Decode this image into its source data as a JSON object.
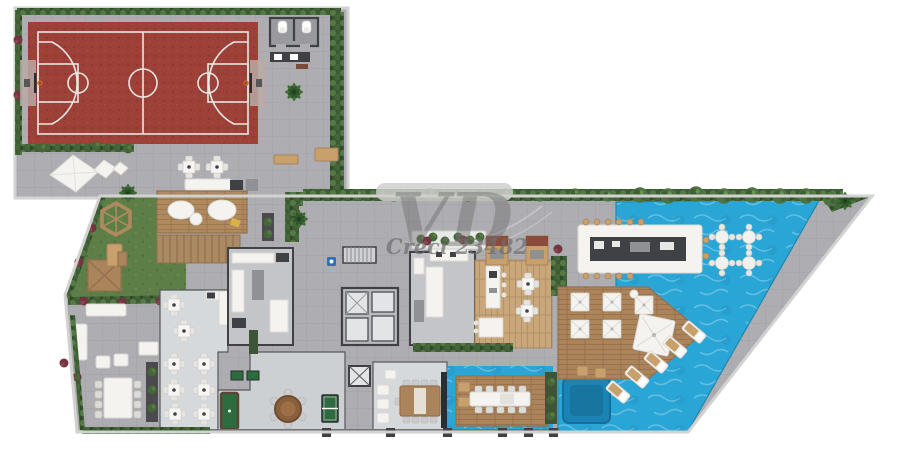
{
  "watermark": {
    "logo": "VD",
    "license": "Creci 23482"
  },
  "colors": {
    "bg": "#ffffff",
    "rim": "#d2d2d0",
    "paving": "#aeaeb2",
    "paving_line": "#9e9ea2",
    "floor_light": "#d6d9dc",
    "floor_mid": "#c3c5c9",
    "wall": "#3f4144",
    "court": "#9c4038",
    "court_line": "#efe6e2",
    "lawn": "#5d7f47",
    "hedge": "#3e5c34",
    "tree": "#4e7340",
    "pool": "#2aa6d6",
    "spa": "#1b84b4",
    "deck_wood": "#ab845c",
    "floor_wood": "#c9a77a",
    "furniture_white": "#f4f3f0",
    "furniture_tan": "#c8a06c",
    "accent_flower": "#72343f",
    "accessible_blue": "#2f6fb8",
    "games_green": "#2e6b3e",
    "poker_wood": "#8a5f3c",
    "watermark_gray": "#6f6f6f"
  }
}
